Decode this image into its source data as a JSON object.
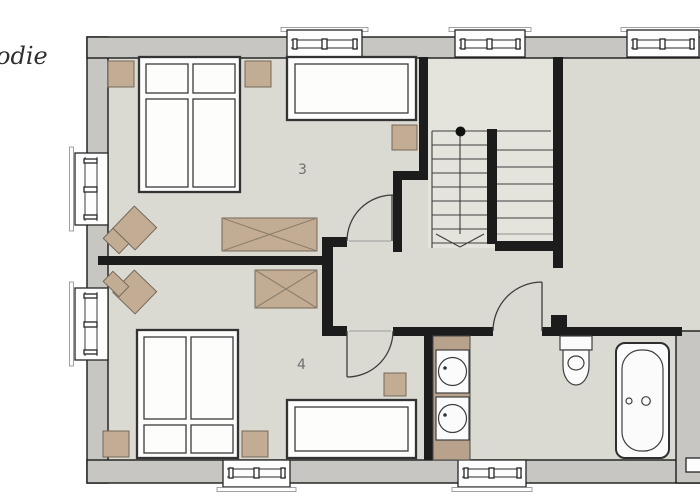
{
  "annotation": {
    "handwritten_text": "odie"
  },
  "room_labels": {
    "room3": "3",
    "room4": "4"
  },
  "inventory": {
    "room3_furniture": [
      "double bed",
      "nightstand",
      "nightstand",
      "single bed",
      "side table",
      "dresser",
      "armchair"
    ],
    "room4_furniture": [
      "double bed",
      "nightstand",
      "nightstand",
      "single bed",
      "side table",
      "dresser",
      "armchair"
    ],
    "bathroom_fixtures": [
      "vanity with two round sinks",
      "toilet",
      "bathtub"
    ],
    "circulation": [
      "u-shaped staircase",
      "down-direction arrow",
      "stair start dot"
    ]
  },
  "palette": {
    "background": "#ffffff",
    "exterior_wall_fill": "#c7c6c2",
    "wall_outline": "#1a1a1a",
    "interior_wall": "#1c1c1c",
    "floor": "#dbdad2",
    "stair_floor": "#e4e3dc",
    "furniture_tan": "#c3ac94",
    "label_text": "#6f6f6f",
    "note_text": "#2e2e2e"
  }
}
